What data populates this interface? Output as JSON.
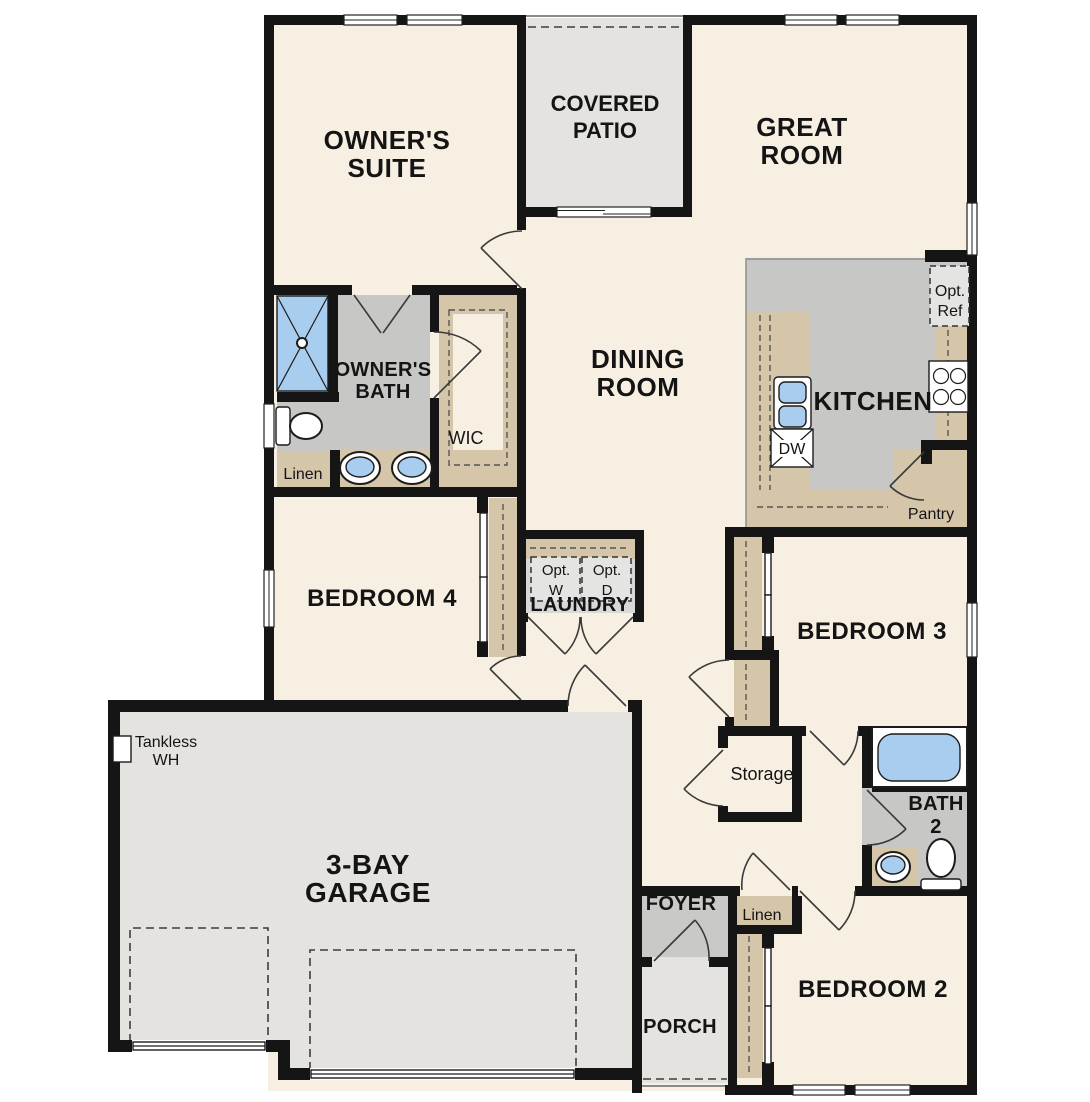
{
  "plan_title": "Single-story floor plan",
  "colors": {
    "cream": "#f7efe2",
    "gray": "#c7c7c5",
    "light": "#e4e3e0",
    "tan": "#d5c6a9",
    "blue": "#a9cdee",
    "laundry": "#d8d8d8",
    "foyer": "#c9c9c7",
    "optbox": "#e4e4e3",
    "wall": "#151515"
  },
  "rooms": {
    "owners_suite": {
      "line1": "OWNER'S",
      "line2": "SUITE"
    },
    "covered_patio": {
      "line1": "COVERED",
      "line2": "PATIO"
    },
    "great_room": {
      "line1": "GREAT",
      "line2": "ROOM"
    },
    "owners_bath": {
      "line1": "OWNER'S",
      "line2": "BATH"
    },
    "wic": {
      "label": "WIC"
    },
    "linen_owners": {
      "label": "Linen"
    },
    "dining_room": {
      "line1": "DINING",
      "line2": "ROOM"
    },
    "kitchen": {
      "label": "KITCHEN"
    },
    "pantry": {
      "label": "Pantry"
    },
    "bedroom4": {
      "label": "BEDROOM 4"
    },
    "laundry": {
      "label": "LAUNDRY"
    },
    "bedroom3": {
      "label": "BEDROOM 3"
    },
    "storage": {
      "label": "Storage"
    },
    "garage": {
      "line1": "3-BAY",
      "line2": "GARAGE"
    },
    "bath2": {
      "line1": "BATH",
      "line2": "2"
    },
    "foyer": {
      "label": "FOYER"
    },
    "linen_hall": {
      "label": "Linen"
    },
    "porch": {
      "label": "PORCH"
    },
    "bedroom2": {
      "label": "BEDROOM 2"
    }
  },
  "fixtures": {
    "opt_ref": {
      "line1": "Opt.",
      "line2": "Ref"
    },
    "dishwasher": {
      "label": "DW"
    },
    "opt_washer": {
      "line1": "Opt.",
      "line2": "W"
    },
    "opt_dryer": {
      "line1": "Opt.",
      "line2": "D"
    },
    "tankless_wh": {
      "line1": "Tankless",
      "line2": "WH"
    }
  }
}
